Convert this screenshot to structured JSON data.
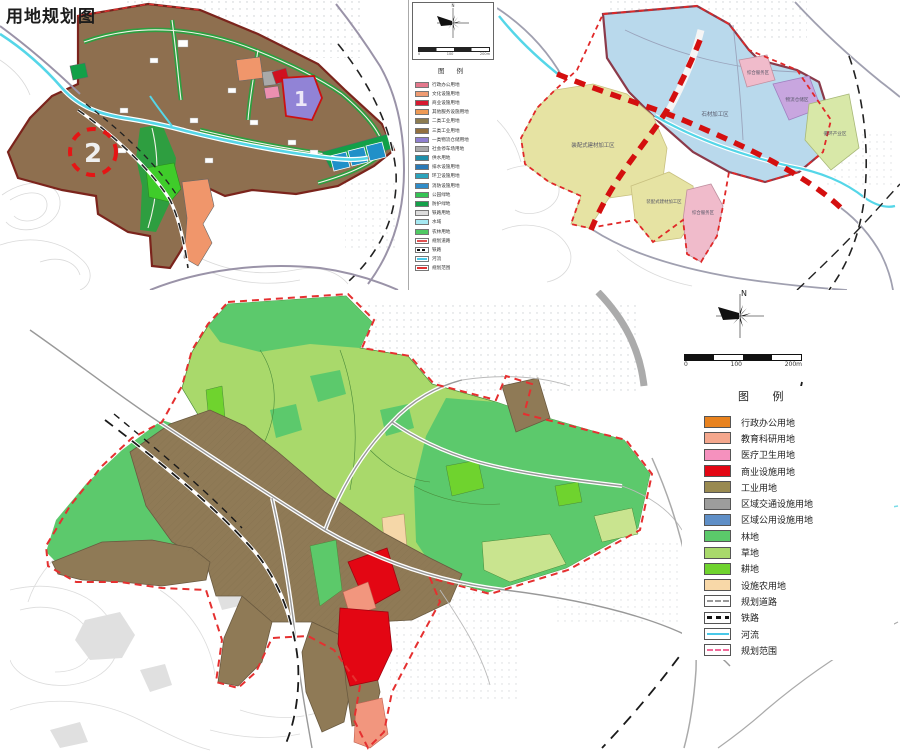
{
  "title": "用地规划图",
  "panel1": {
    "compass_label": "N",
    "scale_labels": [
      "0",
      "100",
      "200m"
    ],
    "markers": [
      {
        "label": "1"
      },
      {
        "label": "2"
      }
    ],
    "legend": {
      "header": "图  例",
      "items": [
        {
          "label": "行政办公用地",
          "color": "#e4788c",
          "type": "fill"
        },
        {
          "label": "文化设施用地",
          "color": "#ef9b72",
          "type": "fill"
        },
        {
          "label": "商业设施用地",
          "color": "#d81830",
          "type": "fill"
        },
        {
          "label": "其他服务设施用地",
          "color": "#ee9a55",
          "type": "fill"
        },
        {
          "label": "二类工业用地",
          "color": "#8d7c50",
          "type": "fill"
        },
        {
          "label": "三类工业用地",
          "color": "#93703f",
          "type": "fill"
        },
        {
          "label": "一类物流仓储用地",
          "color": "#8f7fd0",
          "type": "fill"
        },
        {
          "label": "社会停车场用地",
          "color": "#a9a9a9",
          "type": "fill"
        },
        {
          "label": "供水用地",
          "color": "#1f8fa9",
          "type": "fill"
        },
        {
          "label": "排水设施用地",
          "color": "#2a7ab8",
          "type": "fill"
        },
        {
          "label": "环卫设施用地",
          "color": "#2ba3bc",
          "type": "fill"
        },
        {
          "label": "消防设施用地",
          "color": "#2f8cc8",
          "type": "fill"
        },
        {
          "label": "公园绿地",
          "color": "#35c455",
          "type": "fill"
        },
        {
          "label": "防护绿地",
          "color": "#14a14a",
          "type": "fill"
        },
        {
          "label": "铁路用地",
          "color": "#dcdcdc",
          "type": "fill"
        },
        {
          "label": "水域",
          "color": "#a6e9f2",
          "type": "fill"
        },
        {
          "label": "农林用地",
          "color": "#4fc963",
          "type": "fill"
        },
        {
          "label": "规划道路",
          "color": "#e05050",
          "type": "road"
        },
        {
          "label": "铁路",
          "color": "#111111",
          "type": "railway"
        },
        {
          "label": "河流",
          "color": "#49c8e8",
          "type": "river"
        },
        {
          "label": "规划范围",
          "color": "#e03030",
          "type": "boundary"
        }
      ]
    }
  },
  "panel2": {
    "zones": [
      {
        "label": "石材加工区"
      },
      {
        "label": "综合服务区"
      },
      {
        "label": "物流仓储区"
      },
      {
        "label": "循环产业区"
      },
      {
        "label": "装配式建材加工区"
      },
      {
        "label": "装配式建材加工区"
      },
      {
        "label": "综合服务区"
      }
    ]
  },
  "panel3": {
    "compass_label": "N",
    "scale_labels": [
      "0",
      "100",
      "200m"
    ],
    "legend": {
      "header": "图  例",
      "items": [
        {
          "label": "行政办公用地",
          "color": "#e8821e",
          "type": "fill"
        },
        {
          "label": "教育科研用地",
          "color": "#f4a78d",
          "type": "fill"
        },
        {
          "label": "医疗卫生用地",
          "color": "#f591be",
          "type": "fill"
        },
        {
          "label": "商业设施用地",
          "color": "#e30613",
          "type": "fill"
        },
        {
          "label": "工业用地",
          "color": "#998a50",
          "type": "fill"
        },
        {
          "label": "区域交通设施用地",
          "color": "#9d9d9c",
          "type": "fill"
        },
        {
          "label": "区域公用设施用地",
          "color": "#5f8fc7",
          "type": "fill"
        },
        {
          "label": "林地",
          "color": "#5bc96a",
          "type": "fill"
        },
        {
          "label": "草地",
          "color": "#a9d96b",
          "type": "fill"
        },
        {
          "label": "耕地",
          "color": "#6fd32e",
          "type": "fill"
        },
        {
          "label": "设施农用地",
          "color": "#f8d8a8",
          "type": "fill"
        },
        {
          "label": "规划道路",
          "color": "#999999",
          "type": "road"
        },
        {
          "label": "铁路",
          "color": "#111111",
          "type": "railway"
        },
        {
          "label": "河流",
          "color": "#49c8e8",
          "type": "river"
        },
        {
          "label": "规划范围",
          "color": "#f06a9a",
          "type": "boundary"
        }
      ]
    }
  }
}
